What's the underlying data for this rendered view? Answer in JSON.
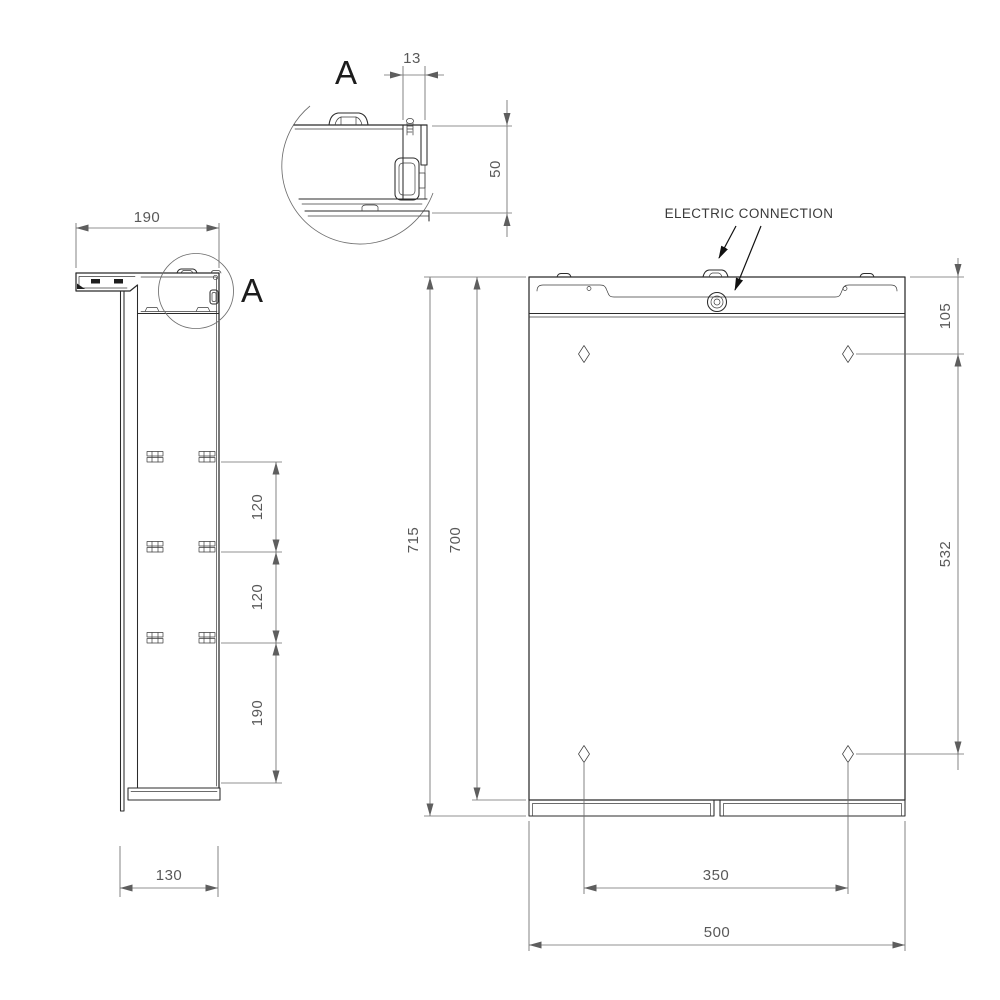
{
  "labels": {
    "detail_title": "A",
    "detail_callout": "A",
    "electric_connection": "ELECTRIC CONNECTION"
  },
  "dimensions": {
    "detail_offset": "13",
    "detail_height": "50",
    "side_top_depth": "190",
    "shelf_spacing_upper": "120",
    "shelf_spacing_lower": "120",
    "shelf_bottom_offset": "190",
    "side_bottom_depth": "130",
    "overall_height": "715",
    "cabinet_height": "700",
    "hole_top_offset": "105",
    "hole_vertical_span": "532",
    "hole_horizontal_span": "350",
    "cabinet_width": "500"
  },
  "colors": {
    "background": "#ffffff",
    "part_edge": "#2b2b2b",
    "detail_line": "#3d3d3d",
    "dimension_line": "#6e6e6e",
    "dimension_text": "#595959",
    "annotation_text": "#3a3a3a",
    "dimension_arrow": "#5e5e5e",
    "annotation_arrow": "#111111"
  }
}
